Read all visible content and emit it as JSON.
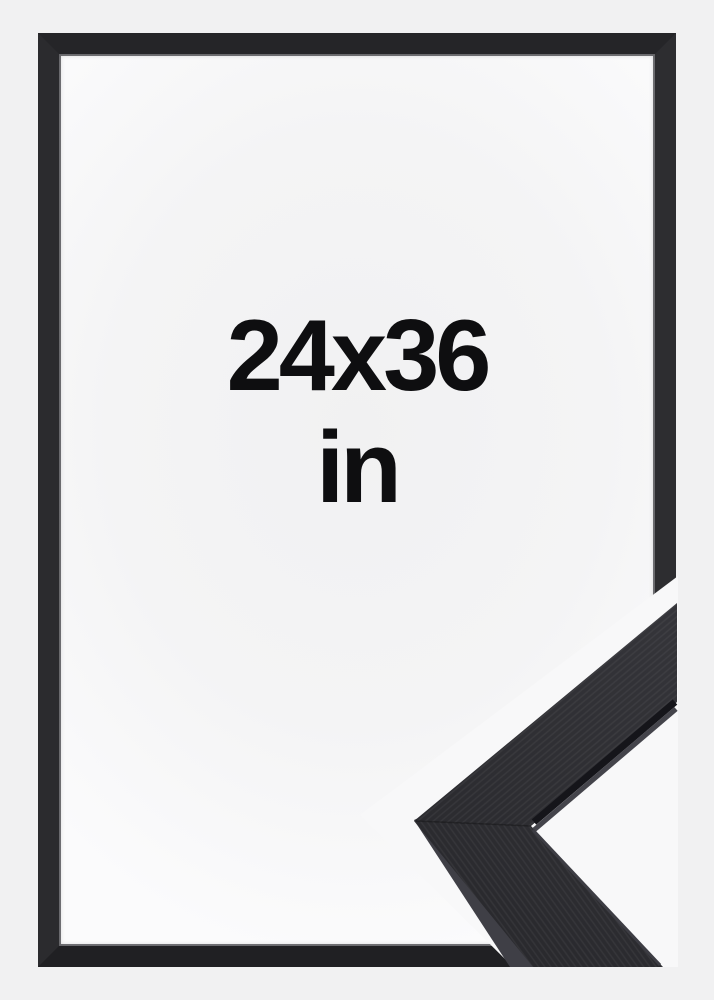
{
  "image": {
    "description": "black picture frame product mockup with corner sample",
    "size_label": "24x36",
    "unit_label": "in"
  },
  "colors": {
    "background": "#f1f1f2",
    "frame_black": "#242427",
    "moulding_face": "#2d2d31",
    "moulding_side": "#3f3f46",
    "text": "#0e0e10",
    "sample_background": "#f8f8f9"
  }
}
